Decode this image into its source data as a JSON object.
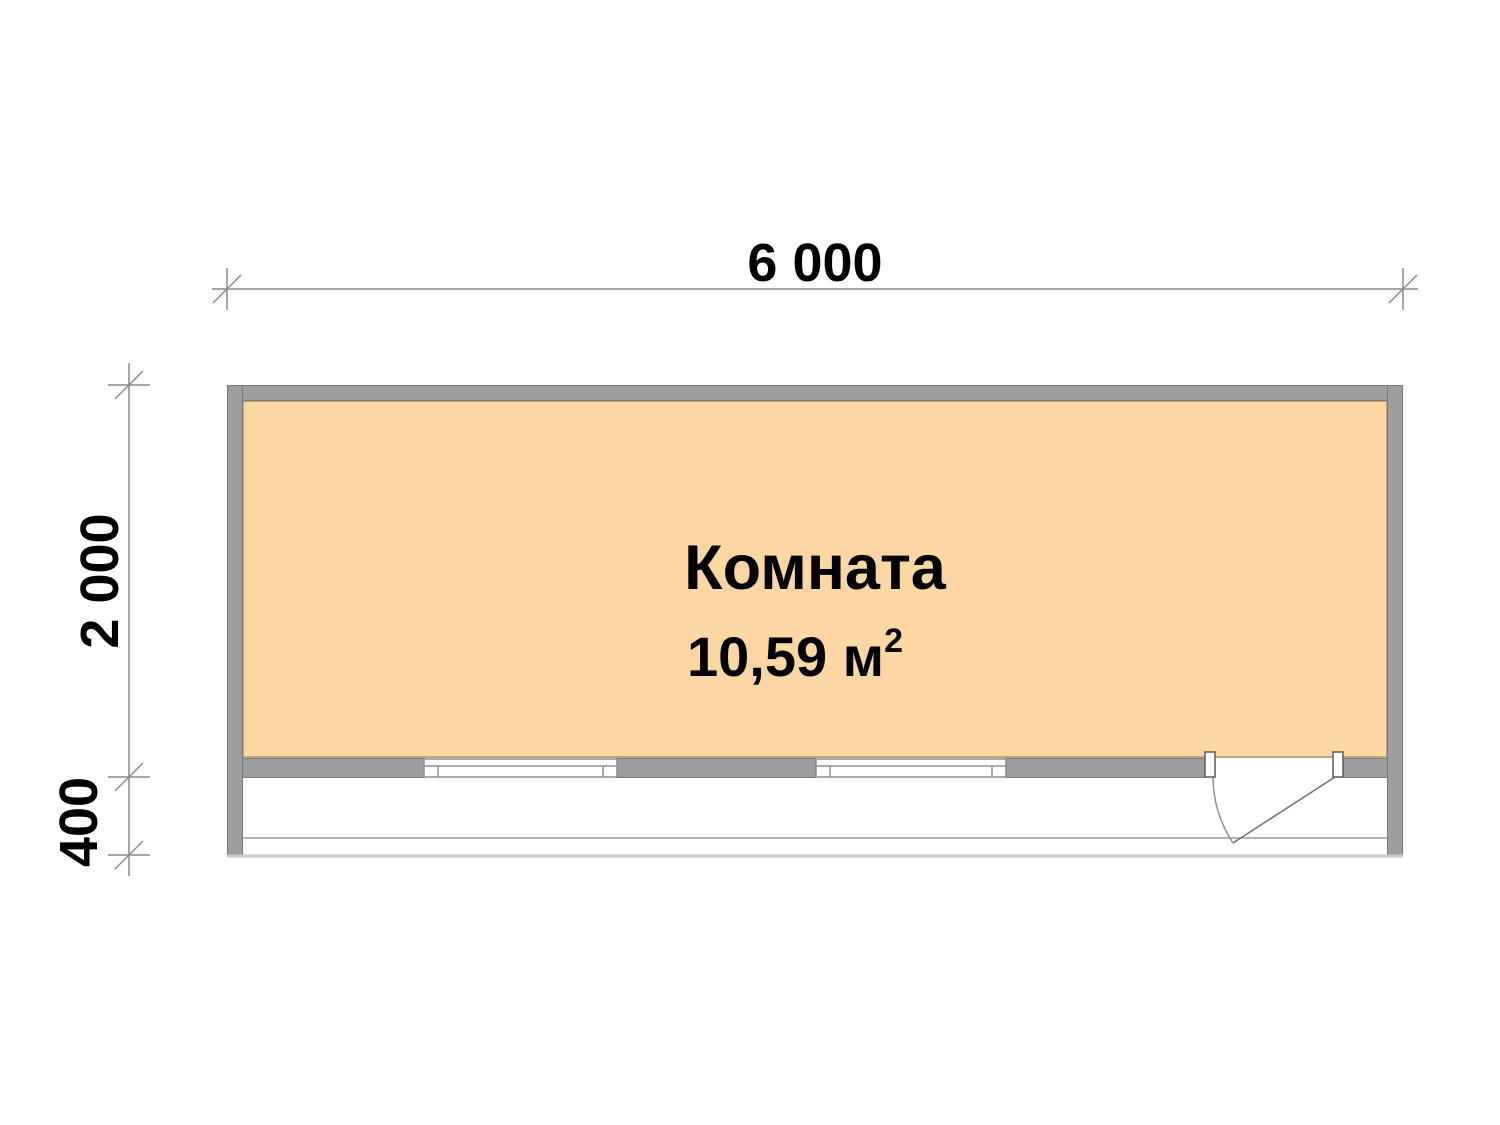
{
  "plan": {
    "room": {
      "name": "Комната",
      "area_value": "10,59 м",
      "area_exponent": "2"
    },
    "dimensions": {
      "width_label": "6 000",
      "depth_label": "2 000",
      "porch_label": "400"
    },
    "colors": {
      "wall_fill": "#9d9d9d",
      "wall_edge": "#787878",
      "room_fill": "#fcd7a3",
      "room_border": "#c3a57c",
      "dimension_line": "#8a8a8a",
      "porch_edge": "#cccccc",
      "label_text": "#000000"
    }
  }
}
